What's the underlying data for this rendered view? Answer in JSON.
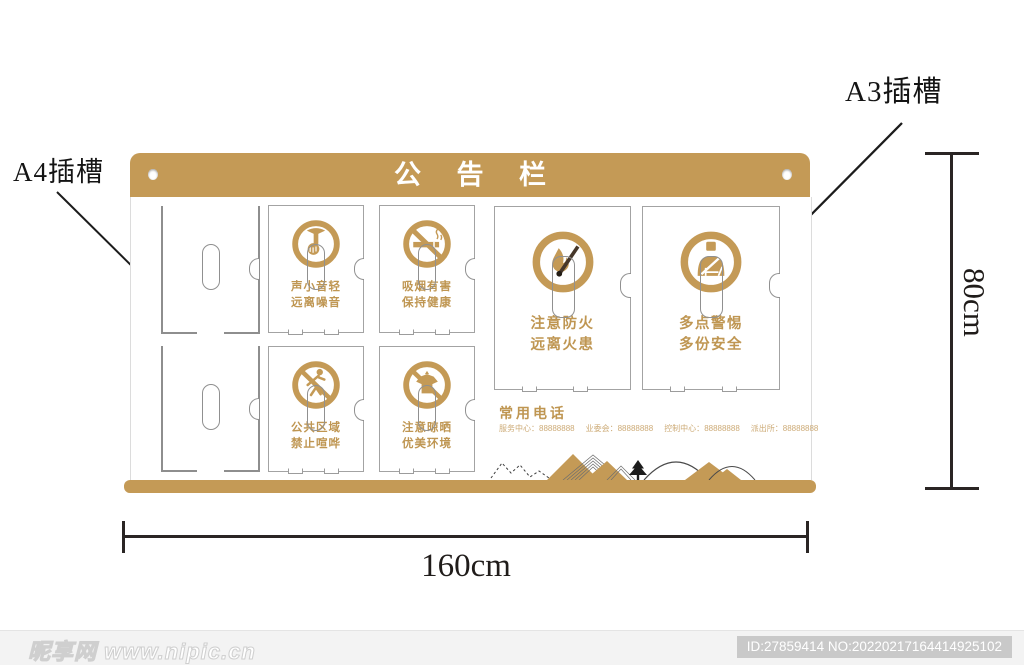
{
  "colors": {
    "gold": "#C49A56",
    "caption_gold": "#BF9652",
    "phone_gold": "#CDAB77",
    "cut_line_gray": "#8e8e8e",
    "dimension_black": "#2a2524",
    "watermark_bar": "#f3f3f3"
  },
  "annotations": {
    "a4_slot": "A4插槽",
    "a3_slot": "A3插槽",
    "width_dim": "160cm",
    "height_dim": "80cm"
  },
  "board": {
    "title": "公 告 栏",
    "cards": [
      {
        "icon": "quiet-icon",
        "line1": "声小音轻",
        "line2": "远离噪音"
      },
      {
        "icon": "no-smoking-icon",
        "line1": "吸烟有害",
        "line2": "保持健康"
      },
      {
        "icon": "no-clamor-icon",
        "line1": "公共区域",
        "line2": "禁止喧哗"
      },
      {
        "icon": "no-drying-icon",
        "line1": "注意晾晒",
        "line2": "优美环境"
      },
      {
        "icon": "fire-caution-icon",
        "line1": "注意防火",
        "line2": "远离火患"
      },
      {
        "icon": "theft-alert-icon",
        "line1": "多点警惕",
        "line2": "多份安全"
      }
    ],
    "phones": {
      "title": "常用电话",
      "entries": [
        {
          "label": "服务中心：",
          "number": "88888888"
        },
        {
          "label": "业委会：",
          "number": "88888888"
        },
        {
          "label": "控制中心：",
          "number": "88888888"
        },
        {
          "label": "派出所：",
          "number": "88888888"
        }
      ]
    }
  },
  "watermark": {
    "site": "昵享网 www.nipic.cn",
    "id_text": "ID:27859414 NO:20220217164414925102"
  }
}
